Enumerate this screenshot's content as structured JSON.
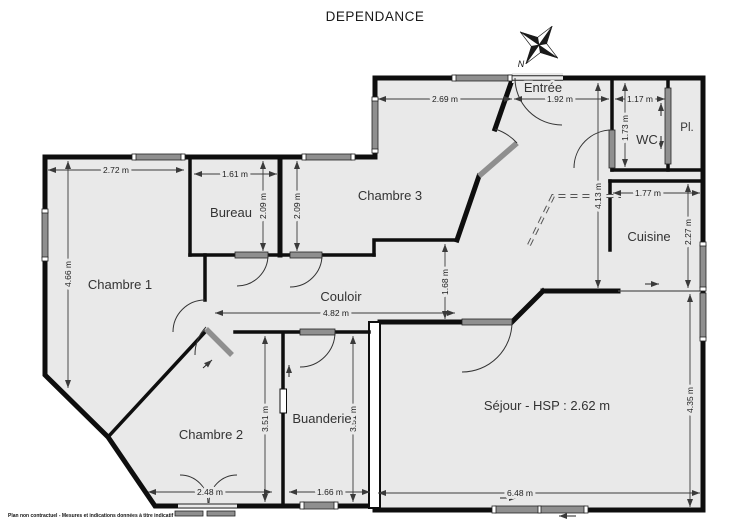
{
  "title": "DEPENDANCE",
  "compass": {
    "north": "N"
  },
  "disclaimer": "Plan non contractuel - Mesures et indications données à titre indicatif",
  "rooms": {
    "chambre1": "Chambre 1",
    "bureau": "Bureau",
    "chambre3": "Chambre 3",
    "couloir": "Couloir",
    "chambre2": "Chambre 2",
    "buanderie": "Buanderie",
    "sejour": "Séjour - HSP : 2.62 m",
    "cuisine": "Cuisine",
    "wc": "WC",
    "placard": "Pl.",
    "entree": "Entrée"
  },
  "dimensions": {
    "chambre1_width": "2.72 m",
    "chambre1_height": "4.66 m",
    "bureau_width": "1.61 m",
    "bureau_height": "2.09 m",
    "chambre3_height": "2.09 m",
    "chambre3_width": "2.69 m",
    "entree_width": "1.92 m",
    "wc_width": "1.17 m",
    "wc_height": "1.73 m",
    "hall_height": "4.13 m",
    "cuisine_width": "1.77 m",
    "cuisine_height": "2.27 m",
    "sejour_height": "4.35 m",
    "sejour_width": "6.48 m",
    "couloir_width": "4.82 m",
    "couloir_link_height": "1.68 m",
    "chambre2_height": "3.51 m",
    "buanderie_height": "3.51 m",
    "chambre2_width": "2.48 m",
    "buanderie_width": "1.66 m"
  },
  "colors": {
    "floor": "#e9e9e9",
    "wall": "#0e0e0e",
    "window": "#8f8f8f",
    "dimension_line": "#3a3a3a",
    "background": "#ffffff"
  }
}
